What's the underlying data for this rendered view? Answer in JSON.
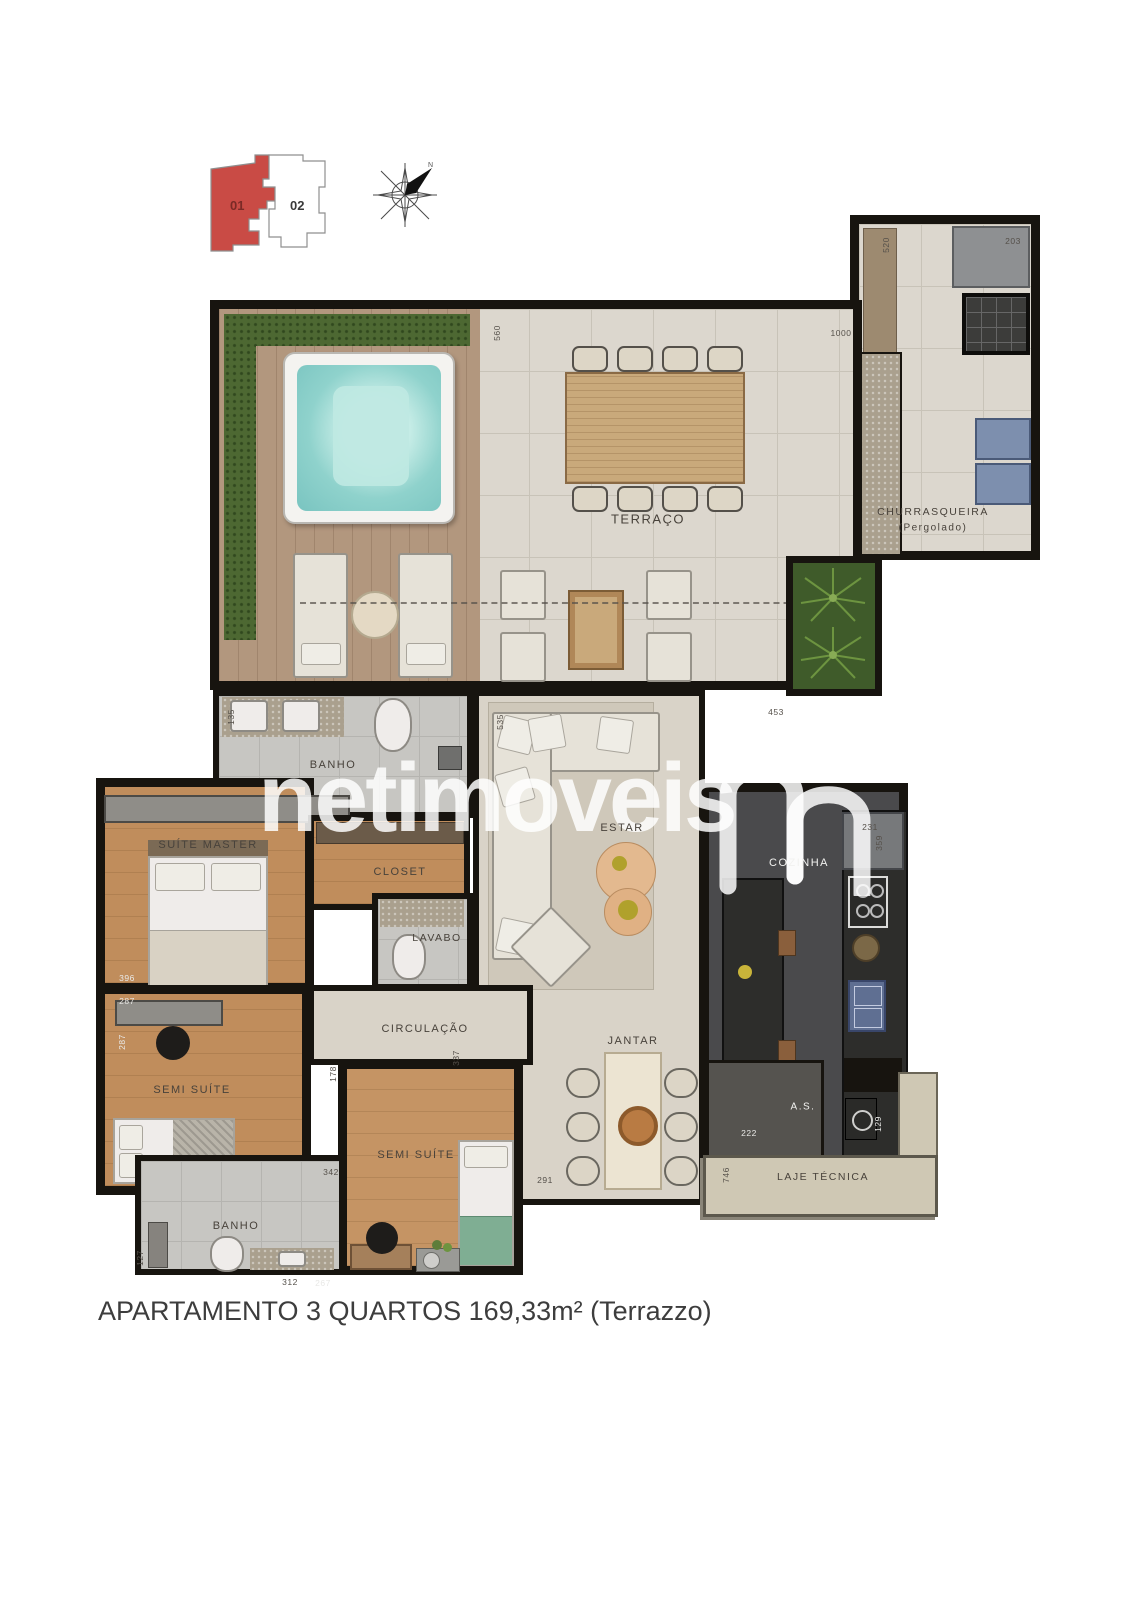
{
  "title": {
    "caption": "APARTAMENTO 3 QUARTOS 169,33m² (Terrazzo)"
  },
  "key_plan": {
    "unit1": "01",
    "unit2": "02"
  },
  "watermark": {
    "text": "netimoveis"
  },
  "colors": {
    "wall": "#17140f",
    "unit1_red": "#c94b45",
    "wood": "#c08d5c",
    "tile": "#dcd7ce",
    "deck": "#b2977e",
    "grass": "#4d6832",
    "water": "#8fd2cc",
    "kitchen_dark": "#2d2d2b"
  },
  "room_labels": [
    {
      "text": "TERRAÇO",
      "x": 648,
      "y": 519,
      "size": 13
    },
    {
      "text": "CHURRASQUEIRA",
      "x": 933,
      "y": 512,
      "size": 10.5
    },
    {
      "text": "(Pergolado)",
      "x": 933,
      "y": 528,
      "size": 10
    },
    {
      "text": "BANHO",
      "x": 333,
      "y": 765,
      "size": 11
    },
    {
      "text": "SUÍTE MASTER",
      "x": 208,
      "y": 845,
      "size": 11
    },
    {
      "text": "CLOSET",
      "x": 400,
      "y": 872,
      "size": 11
    },
    {
      "text": "LAVABO",
      "x": 437,
      "y": 938,
      "size": 10.5
    },
    {
      "text": "ESTAR",
      "x": 622,
      "y": 828,
      "size": 11
    },
    {
      "text": "CIRCULAÇÃO",
      "x": 425,
      "y": 1029,
      "size": 11
    },
    {
      "text": "COZINHA",
      "x": 799,
      "y": 863,
      "size": 11,
      "variant": "light"
    },
    {
      "text": "JANTAR",
      "x": 633,
      "y": 1041,
      "size": 11
    },
    {
      "text": "SEMI SUÍTE",
      "x": 192,
      "y": 1090,
      "size": 11
    },
    {
      "text": "SEMI SUÍTE",
      "x": 416,
      "y": 1155,
      "size": 11
    },
    {
      "text": "BANHO",
      "x": 236,
      "y": 1226,
      "size": 11
    },
    {
      "text": "A.S.",
      "x": 803,
      "y": 1107,
      "size": 10,
      "variant": "light"
    },
    {
      "text": "LAJE TÉCNICA",
      "x": 823,
      "y": 1177,
      "size": 10.5
    }
  ],
  "dimensions": [
    {
      "text": "560",
      "x": 497,
      "y": 333,
      "rot": -90
    },
    {
      "text": "1000",
      "x": 841,
      "y": 333
    },
    {
      "text": "520",
      "x": 886,
      "y": 245,
      "rot": -90
    },
    {
      "text": "203",
      "x": 1013,
      "y": 241
    },
    {
      "text": "453",
      "x": 776,
      "y": 712
    },
    {
      "text": "135",
      "x": 231,
      "y": 717,
      "rot": -90
    },
    {
      "text": "535",
      "x": 500,
      "y": 722,
      "rot": -90
    },
    {
      "text": "396",
      "x": 127,
      "y": 978,
      "variant": "light"
    },
    {
      "text": "287",
      "x": 127,
      "y": 1001,
      "variant": "light"
    },
    {
      "text": "287",
      "x": 122,
      "y": 1042,
      "rot": -90,
      "variant": "light"
    },
    {
      "text": "178",
      "x": 333,
      "y": 1074,
      "rot": -90
    },
    {
      "text": "342",
      "x": 331,
      "y": 1172
    },
    {
      "text": "337",
      "x": 456,
      "y": 1058,
      "rot": -90
    },
    {
      "text": "291",
      "x": 545,
      "y": 1180
    },
    {
      "text": "746",
      "x": 726,
      "y": 1175,
      "rot": -90
    },
    {
      "text": "312",
      "x": 290,
      "y": 1282
    },
    {
      "text": "267",
      "x": 323,
      "y": 1283,
      "variant": "light"
    },
    {
      "text": "127",
      "x": 140,
      "y": 1258,
      "rot": -90
    },
    {
      "text": "222",
      "x": 749,
      "y": 1133,
      "variant": "light"
    },
    {
      "text": "129",
      "x": 878,
      "y": 1124,
      "rot": -90,
      "variant": "light"
    },
    {
      "text": "231",
      "x": 870,
      "y": 827
    },
    {
      "text": "359",
      "x": 879,
      "y": 843,
      "rot": -90
    }
  ]
}
